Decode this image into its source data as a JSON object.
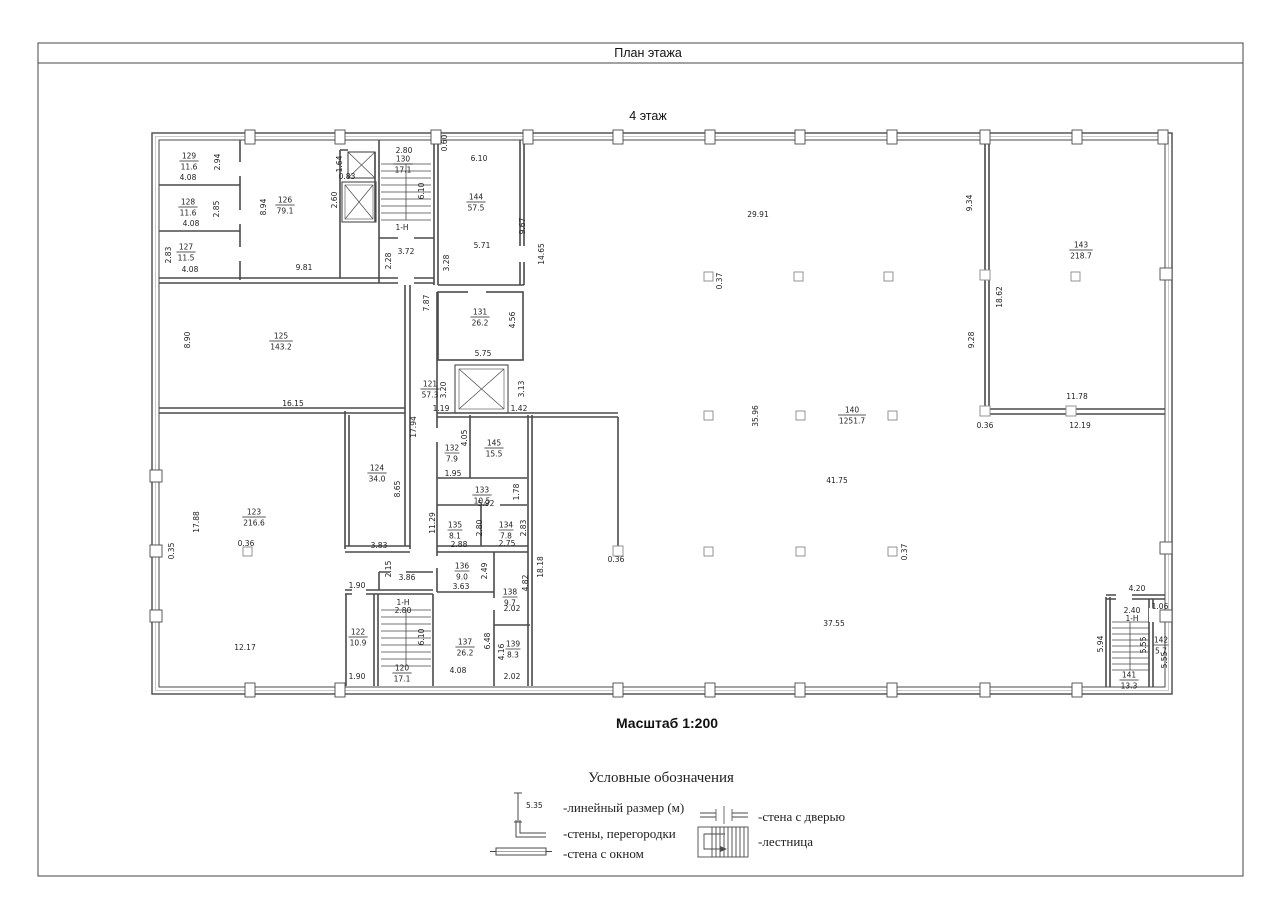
{
  "page": {
    "header_title": "План этажа",
    "floor_title": "4 этаж",
    "scale_label": "Масштаб 1:200"
  },
  "legend": {
    "title": "Условные обозначения",
    "dimension_sample": "5.35",
    "items": {
      "linear": "-линейный размер (м)",
      "walls": "-стены, перегородки",
      "window": "-стена с окном",
      "door": "-стена с дверью",
      "stairs": "-лестница"
    }
  },
  "plan": {
    "rooms": [
      {
        "number": "129",
        "area": "11.6",
        "x": 189,
        "y": 161
      },
      {
        "number": "128",
        "area": "11.6",
        "x": 188,
        "y": 207
      },
      {
        "number": "127",
        "area": "11.5",
        "x": 186,
        "y": 252
      },
      {
        "number": "126",
        "area": "79.1",
        "x": 285,
        "y": 205
      },
      {
        "number": "130",
        "area": "17.1",
        "x": 403,
        "y": 164
      },
      {
        "number": "144",
        "area": "57.5",
        "x": 476,
        "y": 202
      },
      {
        "number": "125",
        "area": "143.2",
        "x": 281,
        "y": 341
      },
      {
        "number": "131",
        "area": "26.2",
        "x": 480,
        "y": 317
      },
      {
        "number": "121",
        "area": "57.3",
        "x": 430,
        "y": 389
      },
      {
        "number": "132",
        "area": "7.9",
        "x": 452,
        "y": 453
      },
      {
        "number": "145",
        "area": "15.5",
        "x": 494,
        "y": 448
      },
      {
        "number": "133",
        "area": "10.5",
        "x": 482,
        "y": 495
      },
      {
        "number": "135",
        "area": "8.1",
        "x": 455,
        "y": 530
      },
      {
        "number": "134",
        "area": "7.8",
        "x": 506,
        "y": 530
      },
      {
        "number": "136",
        "area": "9.0",
        "x": 462,
        "y": 571
      },
      {
        "number": "138",
        "area": "9.7",
        "x": 510,
        "y": 597
      },
      {
        "number": "137",
        "area": "26.2",
        "x": 465,
        "y": 647
      },
      {
        "number": "139",
        "area": "8.3",
        "x": 513,
        "y": 649
      },
      {
        "number": "123",
        "area": "216.6",
        "x": 254,
        "y": 517
      },
      {
        "number": "124",
        "area": "34.0",
        "x": 377,
        "y": 473
      },
      {
        "number": "122",
        "area": "10.9",
        "x": 358,
        "y": 637
      },
      {
        "number": "120",
        "area": "17.1",
        "x": 402,
        "y": 673
      },
      {
        "number": "140",
        "area": "1251.7",
        "x": 852,
        "y": 415
      },
      {
        "number": "143",
        "area": "218.7",
        "x": 1081,
        "y": 250
      },
      {
        "number": "141",
        "area": "13.3",
        "x": 1129,
        "y": 680
      },
      {
        "number": "142",
        "area": "5.7",
        "x": 1161,
        "y": 645
      }
    ],
    "dims": [
      {
        "t": "2.94",
        "x": 217,
        "y": 162,
        "v": true
      },
      {
        "t": "4.08",
        "x": 188,
        "y": 180
      },
      {
        "t": "2.85",
        "x": 216,
        "y": 209,
        "v": true
      },
      {
        "t": "4.08",
        "x": 191,
        "y": 226
      },
      {
        "t": "2.83",
        "x": 168,
        "y": 255,
        "v": true
      },
      {
        "t": "4.08",
        "x": 190,
        "y": 272
      },
      {
        "t": "8.94",
        "x": 263,
        "y": 207,
        "v": true
      },
      {
        "t": "9.81",
        "x": 304,
        "y": 270
      },
      {
        "t": "1.64",
        "x": 339,
        "y": 164,
        "v": true
      },
      {
        "t": "0.83",
        "x": 347,
        "y": 179
      },
      {
        "t": "2.60",
        "x": 334,
        "y": 200,
        "v": true
      },
      {
        "t": "2.80",
        "x": 404,
        "y": 153
      },
      {
        "t": "6.10",
        "x": 421,
        "y": 191,
        "v": true
      },
      {
        "t": "1-H",
        "x": 402,
        "y": 230
      },
      {
        "t": "3.72",
        "x": 406,
        "y": 254
      },
      {
        "t": "2.28",
        "x": 388,
        "y": 261,
        "v": true
      },
      {
        "t": "0.60",
        "x": 444,
        "y": 143,
        "v": true
      },
      {
        "t": "6.10",
        "x": 479,
        "y": 161
      },
      {
        "t": "5.71",
        "x": 482,
        "y": 248
      },
      {
        "t": "9.67",
        "x": 522,
        "y": 226,
        "v": true
      },
      {
        "t": "14.65",
        "x": 541,
        "y": 254,
        "v": true
      },
      {
        "t": "3.28",
        "x": 446,
        "y": 263,
        "v": true
      },
      {
        "t": "7.87",
        "x": 426,
        "y": 303,
        "v": true
      },
      {
        "t": "5.75",
        "x": 483,
        "y": 356
      },
      {
        "t": "4.56",
        "x": 512,
        "y": 320,
        "v": true
      },
      {
        "t": "3.20",
        "x": 443,
        "y": 390,
        "v": true
      },
      {
        "t": "3.13",
        "x": 521,
        "y": 389,
        "v": true
      },
      {
        "t": "1.19",
        "x": 441,
        "y": 411
      },
      {
        "t": "1.42",
        "x": 519,
        "y": 411
      },
      {
        "t": "17.94",
        "x": 413,
        "y": 427,
        "v": true
      },
      {
        "t": "16.15",
        "x": 293,
        "y": 406
      },
      {
        "t": "8.90",
        "x": 187,
        "y": 340,
        "v": true
      },
      {
        "t": "4.05",
        "x": 464,
        "y": 438,
        "v": true
      },
      {
        "t": "1.95",
        "x": 453,
        "y": 476
      },
      {
        "t": "5.92",
        "x": 486,
        "y": 506
      },
      {
        "t": "1.78",
        "x": 516,
        "y": 492,
        "v": true
      },
      {
        "t": "11.29",
        "x": 432,
        "y": 523,
        "v": true
      },
      {
        "t": "2.88",
        "x": 459,
        "y": 547
      },
      {
        "t": "2.80",
        "x": 479,
        "y": 528,
        "v": true
      },
      {
        "t": "2.75",
        "x": 507,
        "y": 546
      },
      {
        "t": "2.83",
        "x": 523,
        "y": 528,
        "v": true
      },
      {
        "t": "3.63",
        "x": 461,
        "y": 589
      },
      {
        "t": "2.49",
        "x": 484,
        "y": 571,
        "v": true
      },
      {
        "t": "2.02",
        "x": 512,
        "y": 611
      },
      {
        "t": "4.82",
        "x": 525,
        "y": 583,
        "v": true
      },
      {
        "t": "4.08",
        "x": 458,
        "y": 673
      },
      {
        "t": "6.48",
        "x": 487,
        "y": 641,
        "v": true
      },
      {
        "t": "4.16",
        "x": 501,
        "y": 652,
        "v": true
      },
      {
        "t": "2.02",
        "x": 512,
        "y": 679
      },
      {
        "t": "18.18",
        "x": 540,
        "y": 567,
        "v": true
      },
      {
        "t": "0.36",
        "x": 616,
        "y": 562
      },
      {
        "t": "8.65",
        "x": 397,
        "y": 489,
        "v": true
      },
      {
        "t": "3.83",
        "x": 379,
        "y": 548
      },
      {
        "t": "2.15",
        "x": 388,
        "y": 569,
        "v": true
      },
      {
        "t": "3.86",
        "x": 407,
        "y": 580
      },
      {
        "t": "1.90",
        "x": 357,
        "y": 588
      },
      {
        "t": "17.88",
        "x": 196,
        "y": 522,
        "v": true
      },
      {
        "t": "0.35",
        "x": 171,
        "y": 551,
        "v": true
      },
      {
        "t": "0.36",
        "x": 246,
        "y": 546
      },
      {
        "t": "12.17",
        "x": 245,
        "y": 650
      },
      {
        "t": "1.90",
        "x": 357,
        "y": 679
      },
      {
        "t": "1-H",
        "x": 403,
        "y": 605
      },
      {
        "t": "2.80",
        "x": 403,
        "y": 613
      },
      {
        "t": "6.10",
        "x": 421,
        "y": 637,
        "v": true
      },
      {
        "t": "29.91",
        "x": 758,
        "y": 217
      },
      {
        "t": "0.37",
        "x": 719,
        "y": 281,
        "v": true
      },
      {
        "t": "35.96",
        "x": 755,
        "y": 416,
        "v": true
      },
      {
        "t": "41.75",
        "x": 837,
        "y": 483
      },
      {
        "t": "37.55",
        "x": 834,
        "y": 626
      },
      {
        "t": "0.37",
        "x": 904,
        "y": 552,
        "v": true
      },
      {
        "t": "9.34",
        "x": 969,
        "y": 203,
        "v": true
      },
      {
        "t": "18.62",
        "x": 999,
        "y": 297,
        "v": true
      },
      {
        "t": "9.28",
        "x": 971,
        "y": 340,
        "v": true
      },
      {
        "t": "11.78",
        "x": 1077,
        "y": 399
      },
      {
        "t": "0.36",
        "x": 985,
        "y": 428
      },
      {
        "t": "12.19",
        "x": 1080,
        "y": 428
      },
      {
        "t": "4.20",
        "x": 1137,
        "y": 591
      },
      {
        "t": "1.06",
        "x": 1160,
        "y": 609
      },
      {
        "t": "2.40",
        "x": 1132,
        "y": 613
      },
      {
        "t": "1-H",
        "x": 1132,
        "y": 621
      },
      {
        "t": "5.94",
        "x": 1100,
        "y": 644,
        "v": true
      },
      {
        "t": "5.55",
        "x": 1143,
        "y": 645,
        "v": true
      },
      {
        "t": "5.55",
        "x": 1164,
        "y": 660,
        "v": true
      }
    ]
  }
}
